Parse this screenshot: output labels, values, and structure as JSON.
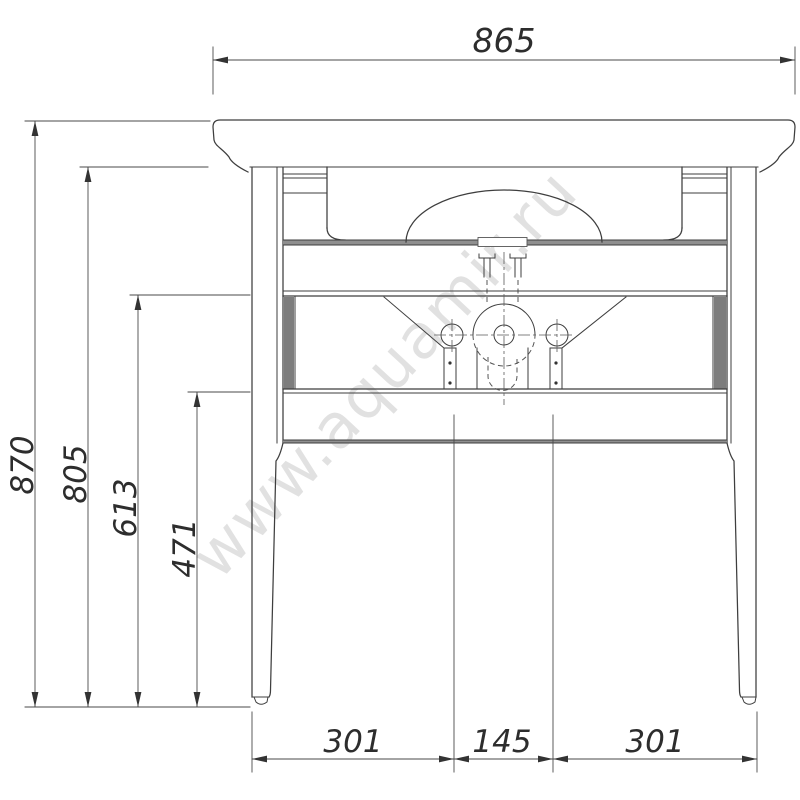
{
  "watermark": {
    "text": "www.aquamir.ru"
  },
  "dimensions": {
    "top_width": "865",
    "overall_height": "870",
    "under_top_height": "805",
    "panel_top_height": "613",
    "panel_bottom_height": "471",
    "bottom_left_span": "301",
    "bottom_center_span": "145",
    "bottom_right_span": "301"
  },
  "colors": {
    "background": "#ffffff",
    "outline": "#3e3e3e",
    "dim_line": "#4a4a4a",
    "dim_text": "#2d2d2d",
    "shading": "#8f8f8f",
    "watermark": "#e1e1e1"
  }
}
